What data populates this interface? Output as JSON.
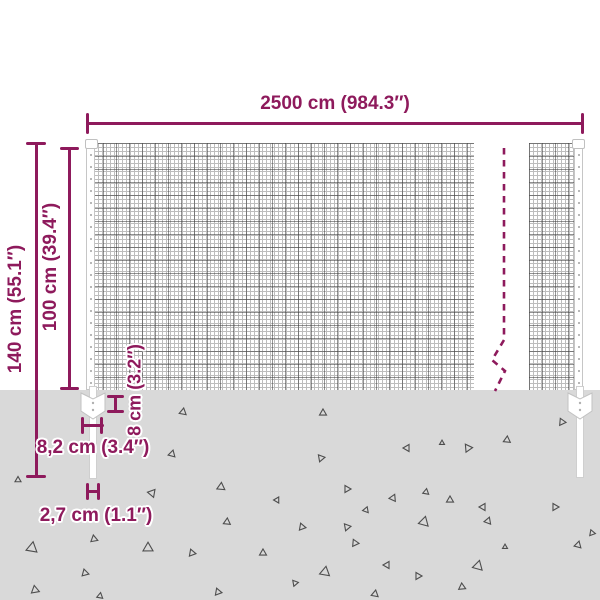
{
  "colors": {
    "accent": "#8e1a5c",
    "ground": "#d9d9d9",
    "mesh_wire": "#bdbdbd",
    "mesh_wire_dark": "#3c3c3c",
    "triangle_outline": "#4d4d4d",
    "post_fill": "#ffffff"
  },
  "labels": {
    "width": "2500 cm (984.3″)",
    "total_height": "140 cm (55.1″)",
    "mesh_height": "100 cm (39.4″)",
    "anchor_depth": "8 cm (3.2″)",
    "post_width": "8,2 cm (3.4″)",
    "spike_width": "2,7 cm (1.1″)"
  },
  "ground": {
    "triangles": [
      [
        18,
        480,
        6,
        240
      ],
      [
        183,
        412,
        7,
        10
      ],
      [
        323,
        413,
        7,
        0
      ],
      [
        468,
        448,
        8,
        205
      ],
      [
        507,
        440,
        7,
        5
      ],
      [
        562,
        422,
        7,
        215
      ],
      [
        172,
        454,
        7,
        15
      ],
      [
        321,
        458,
        7,
        200
      ],
      [
        407,
        448,
        7,
        30
      ],
      [
        442,
        443,
        5,
        0
      ],
      [
        152,
        493,
        8,
        160
      ],
      [
        221,
        487,
        8,
        5
      ],
      [
        277,
        500,
        6,
        150
      ],
      [
        347,
        489,
        7,
        210
      ],
      [
        366,
        510,
        6,
        140
      ],
      [
        393,
        498,
        7,
        25
      ],
      [
        426,
        492,
        6,
        10
      ],
      [
        483,
        507,
        7,
        150
      ],
      [
        227,
        522,
        7,
        5
      ],
      [
        302,
        527,
        7,
        220
      ],
      [
        424,
        522,
        10,
        15
      ],
      [
        450,
        500,
        7,
        240
      ],
      [
        488,
        521,
        7,
        20
      ],
      [
        555,
        507,
        7,
        210
      ],
      [
        94,
        539,
        7,
        230
      ],
      [
        32,
        548,
        11,
        10
      ],
      [
        148,
        548,
        10,
        240
      ],
      [
        192,
        553,
        7,
        220
      ],
      [
        263,
        553,
        7,
        0
      ],
      [
        355,
        543,
        7,
        215
      ],
      [
        347,
        527,
        7,
        200
      ],
      [
        387,
        565,
        7,
        30
      ],
      [
        325,
        572,
        10,
        250
      ],
      [
        418,
        576,
        7,
        210
      ],
      [
        478,
        566,
        10,
        15
      ],
      [
        85,
        573,
        7,
        225
      ],
      [
        35,
        590,
        8,
        230
      ],
      [
        100,
        596,
        6,
        10
      ],
      [
        218,
        592,
        7,
        220
      ],
      [
        295,
        583,
        6,
        200
      ],
      [
        375,
        594,
        7,
        10
      ],
      [
        462,
        587,
        7,
        235
      ],
      [
        578,
        545,
        7,
        15
      ],
      [
        592,
        533,
        6,
        220
      ],
      [
        505,
        547,
        5,
        0
      ]
    ]
  }
}
